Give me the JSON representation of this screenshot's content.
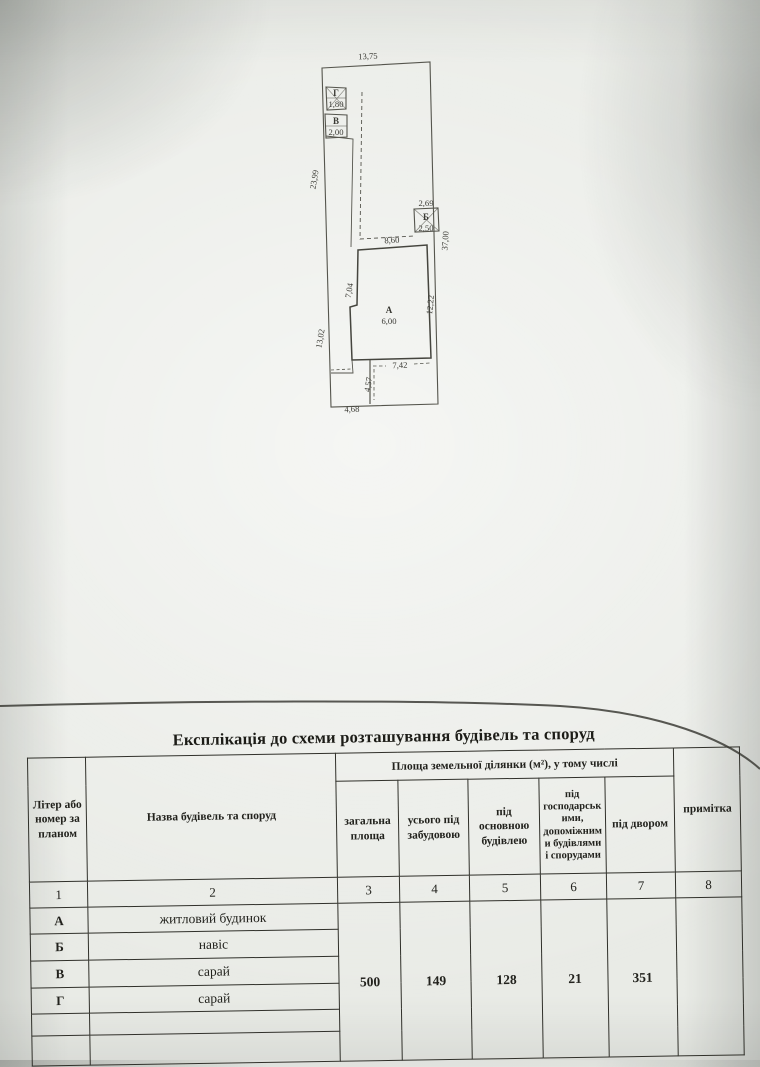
{
  "colors": {
    "paper": "#e9ebe6",
    "plan_line": "#55554d",
    "table_border": "#30302a",
    "ink": "#22221d"
  },
  "plan": {
    "parcel_dims": {
      "top": "13,75",
      "left_upper": "23,99",
      "left_lower": "13,02",
      "right": "37,00",
      "bottom_left": "4,68"
    },
    "building_a": {
      "label": "А",
      "area": "6,00",
      "top": "8,60",
      "left": "7,04",
      "right": "12,22",
      "bottom": "7,42",
      "yard_depth": "4,57"
    },
    "building_b": {
      "label": "Б",
      "width": "2,69",
      "depth": "2,50"
    },
    "building_v": {
      "label": "В",
      "dim": "2,00"
    },
    "building_g": {
      "label": "Г",
      "dim": "1,80"
    }
  },
  "table": {
    "title": "Експлікація до схеми розташування будівель та споруд",
    "area_span_header": "Площа земельної ділянки (м²), у тому числі",
    "col_headers": {
      "letter": "Літер або номер за планом",
      "name": "Назва будівель та споруд",
      "total_area": "загальна площа",
      "built_total": "усього під забудовою",
      "main_building": "під основною будівлею",
      "aux_buildings": "під господарськими, допоміжними будівлями і спорудами",
      "yard": "під двором",
      "note": "примітка"
    },
    "col_numbers": [
      "1",
      "2",
      "3",
      "4",
      "5",
      "6",
      "7",
      "8"
    ],
    "rows": [
      {
        "letter": "А",
        "name": "житловий будинок"
      },
      {
        "letter": "Б",
        "name": "навіс"
      },
      {
        "letter": "В",
        "name": "сарай"
      },
      {
        "letter": "Г",
        "name": "сарай"
      },
      {
        "letter": "",
        "name": ""
      },
      {
        "letter": "",
        "name": ""
      }
    ],
    "totals": {
      "total_area": "500",
      "built_total": "149",
      "main_building": "128",
      "aux_buildings": "21",
      "yard": "351"
    }
  }
}
